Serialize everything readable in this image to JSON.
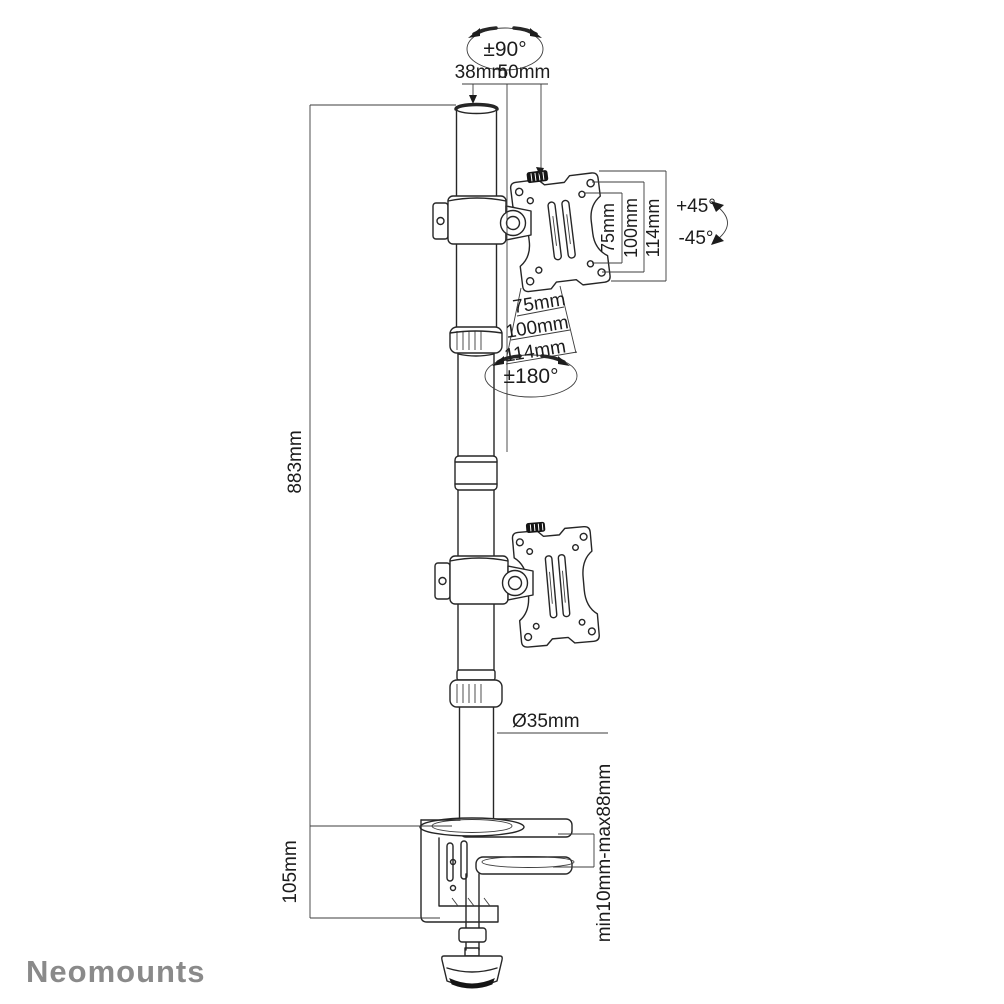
{
  "brand": {
    "logo_text": "Neomounts",
    "logo_color": "#8a8a8a"
  },
  "drawing": {
    "line_color": "#262626",
    "dimension_color": "#3c3c3c",
    "background": "#ffffff"
  },
  "rotations": {
    "pole_swivel": "±90°",
    "plate_rotation": "±180°",
    "tilt_up": "+45°",
    "tilt_down": "-45°"
  },
  "dimensions": {
    "top_inner": "38mm",
    "top_outer": "50mm",
    "vesa_vertical": [
      "75mm",
      "100mm",
      "114mm"
    ],
    "vesa_horizontal": [
      "75mm",
      "100mm",
      "114mm"
    ],
    "pole_height": "883mm",
    "pole_diameter": "Ø35mm",
    "clamp_height": "105mm",
    "desk_thickness_range": "min10mm-max88mm"
  }
}
